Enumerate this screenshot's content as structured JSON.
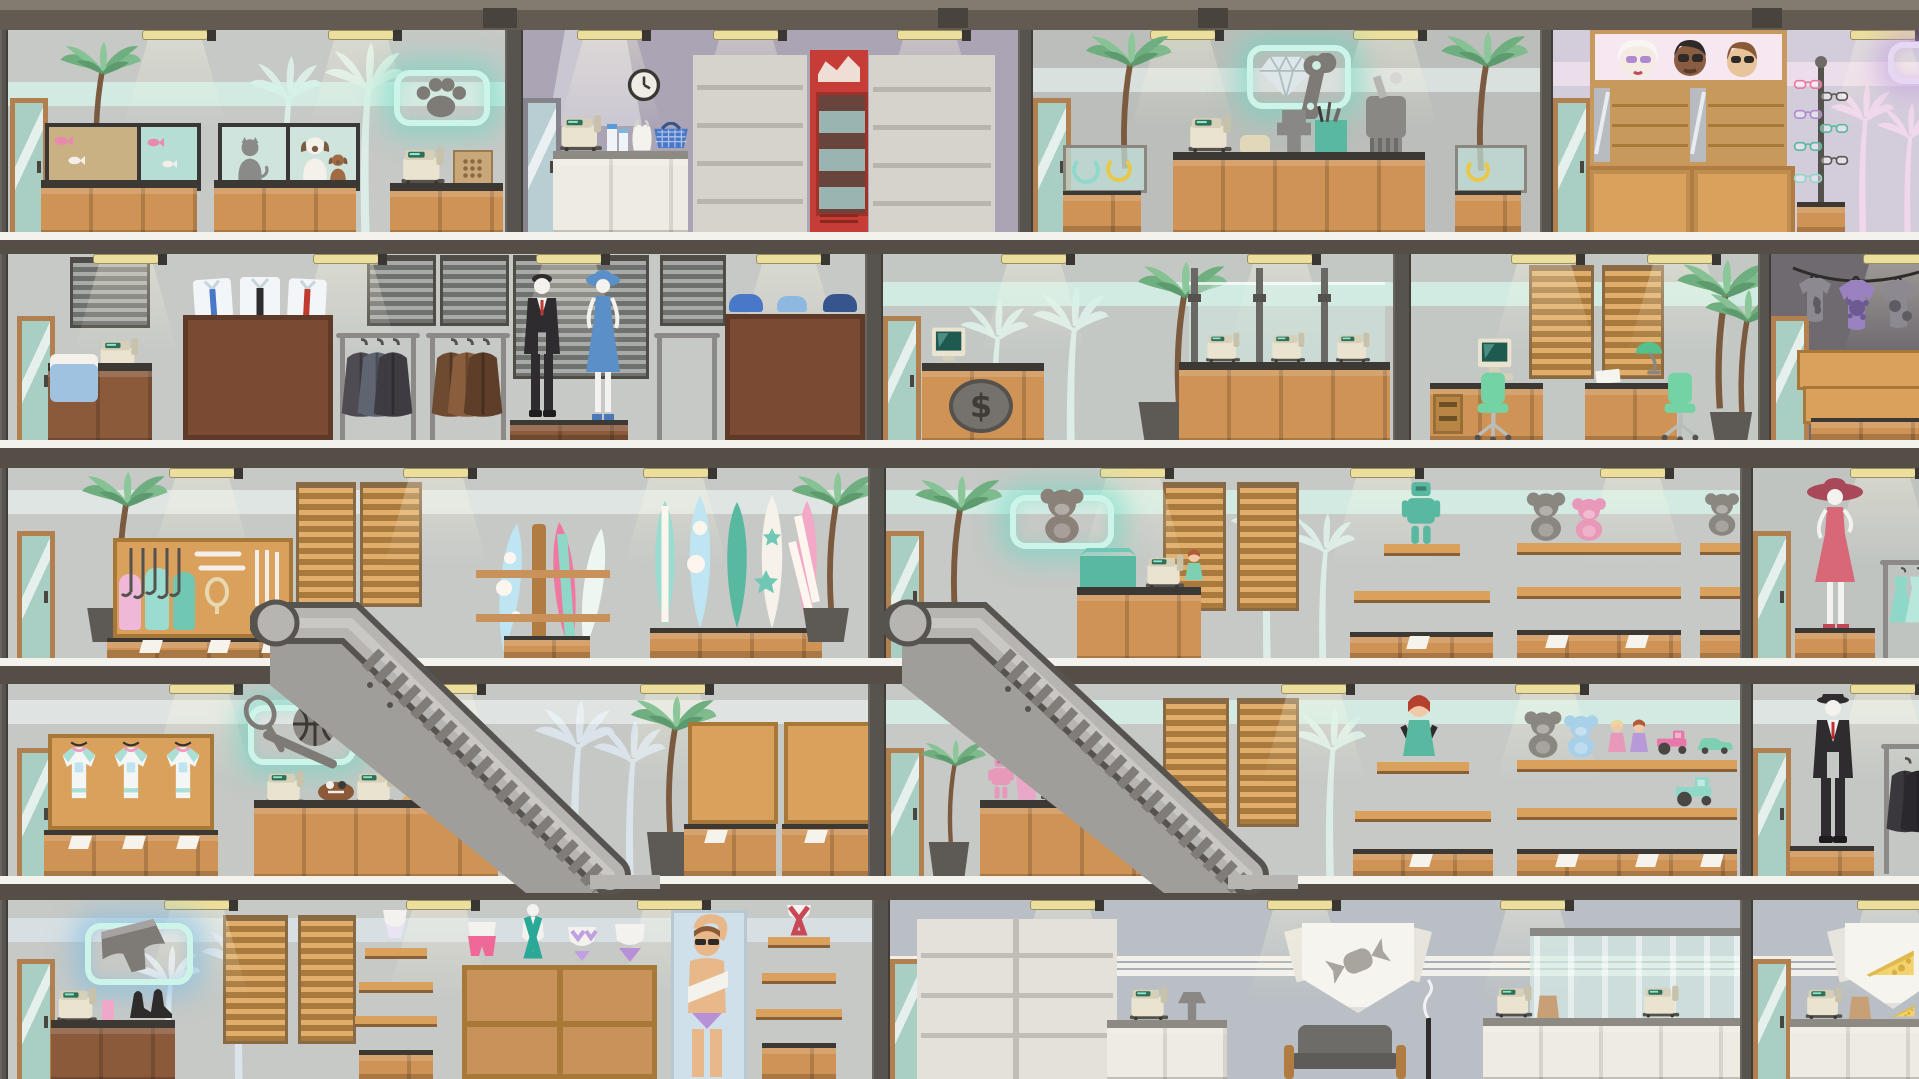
{
  "app": {
    "title": "Shopping mall interior — five-floor cross-section view"
  },
  "palette": {
    "frame": "#57504a",
    "roof_light": "#837a70",
    "roof_dark": "#635b52",
    "slab": "#554e47",
    "floor_strip": "#f4f2ec",
    "wall_gray": "#c6c9c6",
    "wall_lavender": "#aba4b5",
    "wall_warm_gray": "#bbbeba",
    "wall_pink_gray": "#d3ccda",
    "wall_dark": "#6e6a70",
    "wall_blue_gray": "#b9bfc4",
    "wood": "#cf9355",
    "wood_dark": "#8a5a3b",
    "neon_mint": "#cdf4e8",
    "neon_glow": "#63d9c4",
    "neon_glow_purple": "#bb96e4",
    "glyph_gray": "#7e7a76",
    "decal_mint": "#def2ea",
    "decal_pink": "#f4d9ef",
    "decal_blue": "#dde7ef",
    "escalator": "#a09e9a",
    "palm_green": "#74b184",
    "register_beige": "#e9e3cf",
    "accent_green": "#74d3a4",
    "fridge_red": "#c53d36"
  },
  "floors": [
    {
      "id": "floor-1",
      "shops": [
        {
          "id": "pet-shop",
          "label": "Pet shop",
          "sign_icon": "paw-icon",
          "items": [
            "palm-tree",
            "fish-tanks",
            "pet-display-windows",
            "cash-register",
            "parcel-box",
            "counter",
            "palm-wall-decals"
          ]
        },
        {
          "id": "convenience-store",
          "label": "Convenience store",
          "sign_icon": null,
          "items": [
            "wall-clock",
            "extractor-hood",
            "checkout-counter",
            "cash-register",
            "milk-cartons",
            "plastic-bag",
            "shopping-basket",
            "grocery-shelves",
            "drink-fridge",
            "snack-shelves"
          ]
        },
        {
          "id": "jewelry-repair-shop",
          "label": "Jewelry & repair shop",
          "sign_icon": "diamond-wrench-icon",
          "items": [
            "jewelry-case",
            "palm-tree",
            "workbench-counter",
            "cash-register",
            "telephone",
            "bench-vice",
            "tool-cups",
            "polishing-machine"
          ]
        },
        {
          "id": "eyewear-store",
          "label": "Sunglasses store",
          "sign_icon": "sign-partial",
          "items": [
            "faces-display-banner",
            "sunglasses-shelves",
            "rotating-stand",
            "pink-palm-decals"
          ]
        }
      ]
    },
    {
      "id": "floor-2",
      "shops": [
        {
          "id": "menswear-store",
          "label": "Menswear store",
          "sign_icon": null,
          "items": [
            "checkout-counter",
            "folded-jeans",
            "window-blinds",
            "shirt-cabinet",
            "tie-rack",
            "coat-rack-dark",
            "coat-rack-brown",
            "mannequin-suit",
            "mannequin-blue-dress",
            "display-platform",
            "dress-rack",
            "shelf-cabinet",
            "hats"
          ]
        },
        {
          "id": "bank",
          "label": "Bank",
          "sign_icon": null,
          "emblem": "$",
          "items": [
            "service-desk",
            "dollar-emblem",
            "desktop-computer",
            "palm-tree",
            "teller-counter",
            "glass-partitions",
            "cash-registers"
          ]
        },
        {
          "id": "office",
          "label": "Office",
          "sign_icon": null,
          "items": [
            "wooden-blinds",
            "desk-with-computer",
            "drawer-unit",
            "desk-lamp",
            "papers",
            "office-chairs",
            "palm-trees"
          ]
        },
        {
          "id": "tshirt-shop",
          "label": "T-shirt shop",
          "sign_icon": null,
          "items": [
            "hanging-tees-wire",
            "graphic-tees",
            "shelf-stacks",
            "counter"
          ]
        }
      ]
    },
    {
      "id": "floor-3",
      "shops": [
        {
          "id": "surf-sports-shop",
          "label": "Surf & golf shop",
          "sign_icon": null,
          "items": [
            "palm-tree",
            "equipment-wall-rack",
            "golf-clubs",
            "golf-bags",
            "bats-and-rackets",
            "wooden-blinds",
            "escalator-landing",
            "surfboard-rack",
            "surfboard-stand"
          ]
        },
        {
          "id": "toy-store-upper",
          "label": "Toy store — upper floor",
          "sign_icon": "teddy-bear-icon",
          "items": [
            "palm-tree",
            "escalator-landing",
            "checkout-counter",
            "gift-box",
            "doll",
            "wooden-blinds",
            "figure-pyramid",
            "robot-figure",
            "toy-figures",
            "toy-boxes",
            "teddy-shelf",
            "toy-cars",
            "books"
          ]
        },
        {
          "id": "dress-boutique",
          "label": "Dress boutique",
          "sign_icon": null,
          "items": [
            "mannequin-red-dress",
            "pedestal",
            "dress-rack"
          ]
        }
      ]
    },
    {
      "id": "floor-4",
      "shops": [
        {
          "id": "sporting-goods",
          "label": "Sporting goods store",
          "sign_icon": "basketball-racket-icon",
          "items": [
            "jersey-display",
            "checkout-counter",
            "cash-registers",
            "football",
            "baseball-bat",
            "escalator",
            "palm-tree",
            "ball-rack"
          ]
        },
        {
          "id": "toy-store-lower",
          "label": "Toy store — lower floor",
          "sign_icon": null,
          "items": [
            "palm-tree",
            "checkout-counter",
            "toy-robot",
            "toy-tractor",
            "escalator",
            "wooden-blinds",
            "doll-pyramid",
            "plush-shelf",
            "toy-boxes"
          ]
        },
        {
          "id": "suit-shop",
          "label": "Suit shop",
          "sign_icon": null,
          "items": [
            "mannequin-black-suit",
            "pedestal",
            "coat-rack"
          ]
        }
      ]
    },
    {
      "id": "floor-5",
      "shops": [
        {
          "id": "underwear-shop",
          "label": "Underwear & swimwear shop",
          "sign_icon": "boxer-shorts-icon",
          "items": [
            "cash-register",
            "pen-cup",
            "heels",
            "counter",
            "wooden-blinds",
            "tiered-display",
            "cubby-shelf",
            "torso-mannequins",
            "model-poster"
          ]
        },
        {
          "id": "confectionery",
          "label": "Confectionery & deli",
          "sign_icon": "candy-banner-icon",
          "items": [
            "package-shelves",
            "cash-register",
            "grinder",
            "counter",
            "armchair",
            "candle-stand",
            "deli-display-case"
          ]
        },
        {
          "id": "cheese-shop",
          "label": "Cheese shop",
          "sign_icon": "cheese-banner-icon",
          "items": [
            "cash-register",
            "paper-bag",
            "cheese-wedge",
            "counter"
          ]
        }
      ]
    }
  ],
  "escalators": [
    {
      "id": "escalator-left",
      "label": "Escalator",
      "connects": [
        "floor-4",
        "floor-3"
      ]
    },
    {
      "id": "escalator-right",
      "label": "Escalator",
      "connects": [
        "floor-4",
        "floor-3"
      ]
    }
  ]
}
